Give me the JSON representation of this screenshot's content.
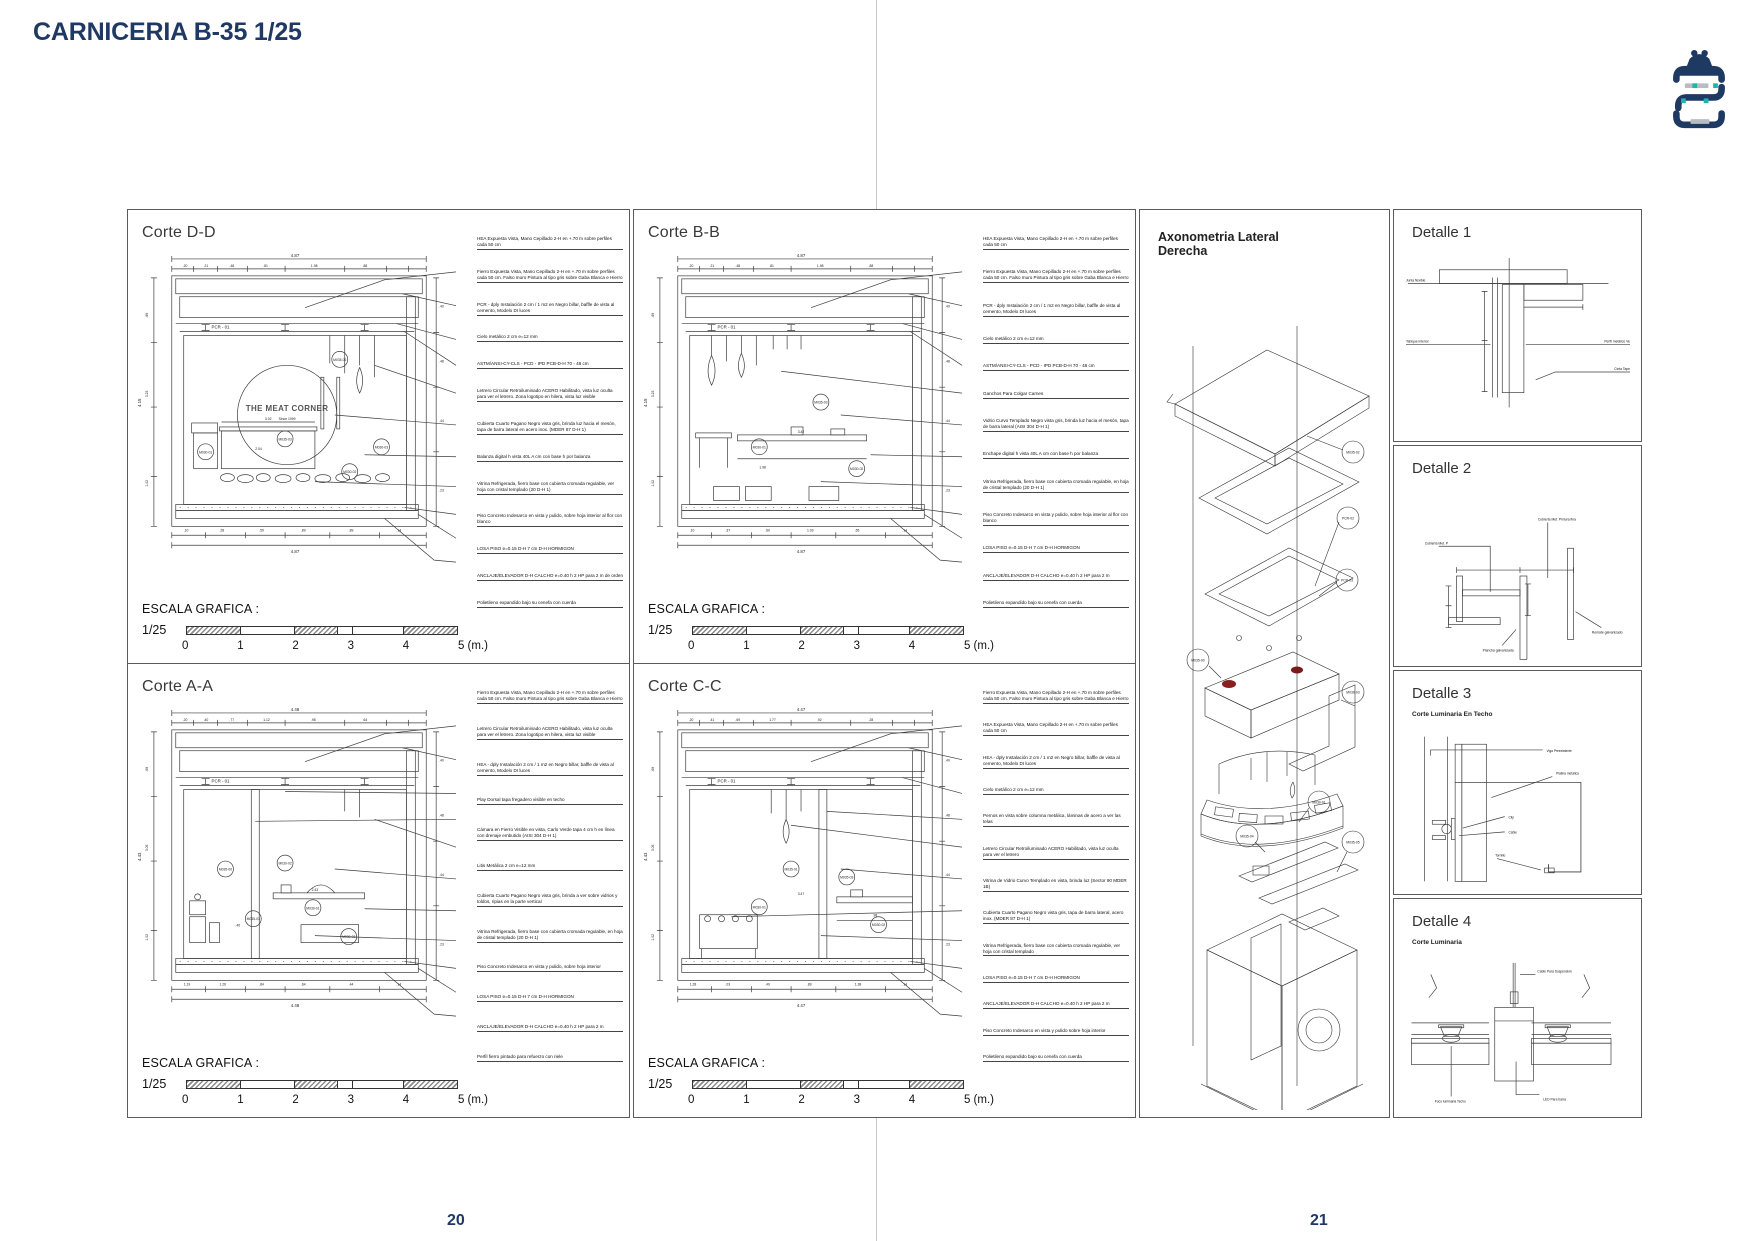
{
  "page": {
    "title": "CARNICERIA B-35 1/25",
    "page_number_left": "20",
    "page_number_right": "21",
    "accent_color": "#203864"
  },
  "scale": {
    "label": "ESCALA GRAFICA :",
    "ratio": "1/25",
    "ticks": [
      "0",
      "1",
      "2",
      "3",
      "4"
    ],
    "end_label": "5 (m.)"
  },
  "cortes": [
    {
      "title": "Corte D-D",
      "beam_label": "PCR - 01",
      "logo_text": "THE MEAT CORNER",
      "logo_sub": "Since 1999",
      "dims": {
        "top_total": "4.87",
        "bottom_total": "4.87",
        "height_total": "4.15",
        "top_segs": [
          ".20",
          ".21",
          ".48",
          ".81",
          "1.98",
          ".88"
        ],
        "bottom_segs": [
          ".10",
          ".28",
          ".59",
          ".89",
          ".89",
          ".14"
        ],
        "left_segs": [
          ".69",
          "3.23",
          "1.02"
        ],
        "right_segs": [
          ".40",
          ".48",
          ".44",
          ".23"
        ],
        "inner": [
          "3.02",
          "2.04"
        ]
      },
      "bubbles": [
        "M035-02",
        "M035-03",
        "M030-01",
        "M030-02",
        "M030-03"
      ],
      "annotations": [
        "HEA Expuesta Vista, Mano Cepillado 2-H en +.70 m sobre perfiles cada 50 cm",
        "Fierro Expuesta Vista, Mano Cepillado 2-H en +.70 m sobre perfiles cada 50 cm. Falso muro Pintura al tipo gris sobre Gaba Blanca e Hierro",
        "PCR - dply Instalación 2 cm / 1 m2 en Negro billar, baffle de vista al cemento, Modelo DI luces",
        "Cielo metálico 2 cm e=12 mm",
        "ASTM/ANSI-CY-CLS - PCD - IPD PCB-D-H 70 - 48 cm",
        "Letrero Circular Retroiluminado ACERO Habilitado, vista luz oculta para ver el letrero. Zona logotipo en hilera, vista luz visible",
        "Cubierta Cuarto Pagano Negro vista gris, brinda luz hacia el mesón, tapa de barra lateral en acero inox. (MDER 87 D-H 1)",
        "Balanza digital h vista 40L A cm con base h por balanza",
        "Vitrina Refrigerada, fierro base con cubierta cromada regulable, ver hoja con cristal templado (20 D-H 1)",
        "Piso Concreto Indesarco en vista y pulido, sobre hoja interior al flor con blanco",
        "LOSA PISO e=0.15 D-H 7 cm D-H HORMIGON",
        "ANCLAJE/ELEVADOR D-H CALCHO e=0.40 h 2 HP para 2 m de orden",
        "Polietileno expandido bajo su cenefa con cuerda"
      ]
    },
    {
      "title": "Corte B-B",
      "beam_label": "PCR - 01",
      "dims": {
        "top_total": "4.87",
        "bottom_total": "4.87",
        "height_total": "4.15",
        "top_segs": [
          ".20",
          ".21",
          ".48",
          ".81",
          "1.98",
          ".88"
        ],
        "bottom_segs": [
          ".10",
          ".37",
          ".60",
          "1.03",
          ".65",
          ".14"
        ],
        "left_segs": [
          ".69",
          "3.23",
          "1.02"
        ],
        "right_segs": [
          ".40",
          ".48",
          ".44",
          ".23"
        ],
        "inner": [
          "3.42",
          "1.98"
        ]
      },
      "bubbles": [
        "M035-03",
        "M030-01",
        "M030-02"
      ],
      "annotations": [
        "HEA Expuesta Vista, Mano Cepillado 2-H en +.70 m sobre perfiles cada 50 cm",
        "Fierro Expuesta Vista, Mano Cepillado 2-H en +.70 m sobre perfiles cada 50 cm. Falso muro Pintura al tipo gris sobre Gaba Blanca e Hierro",
        "PCR - dply Instalación 2 cm / 1 m2 en Negro billar, baffle de vista al cemento, Modelo DI luces",
        "Cielo metálico 2 cm e=12 mm",
        "ASTM/ANSI-CY-CLS - PCD - IPD PCB-D-H 70 - 48 cm",
        "Ganchos Para Colgar Carnes",
        "Vidrio Curvo Templado Negro vista gris, brinda luz hacia el mesón, tapa de barra lateral (AISI 304 D-H 1)",
        "Enchape digital h vista 40L A cm con base h por balanza",
        "Vitrina Refrigerada, fierro base con cubierta cromada regulable, en hoja de cristal templado (20 D-H 1)",
        "Piso Concreto Indesarco en vista y pulido, sobre hoja interior al flor con blanco",
        "LOSA PISO e=0.15 D-H 7 cm D-H HORMIGON",
        "ANCLAJE/ELEVADOR D-H CALCHO e=0.40 h 2 HP para 2 m",
        "Polietileno expandido bajo su cenefa con cuerda"
      ]
    },
    {
      "title": "Corte A-A",
      "beam_label": "PCR - 01",
      "dims": {
        "top_total": "4.48",
        "bottom_total": "4.48",
        "height_total": "4.43",
        "top_segs": [
          ".20",
          ".40",
          ".77",
          "1.12",
          ".98",
          ".64"
        ],
        "bottom_segs": [
          "1.19",
          "1.26",
          ".84",
          ".64",
          ".44",
          ".14"
        ],
        "left_segs": [
          ".69",
          "3.05",
          "1.02"
        ],
        "right_segs": [
          ".40",
          ".48",
          ".44",
          ".23"
        ],
        "inner": [
          "2.43",
          ".40"
        ]
      },
      "bubbles": [
        "M035-00",
        "M030-02",
        "M030-01",
        "M035-03",
        "M030-03"
      ],
      "annotations": [
        "Fierro Expuesta Vista, Mano Cepillado 2-H en +.70 m sobre perfiles cada 50 cm. Falso muro Pintura al tipo gris sobre Gaba Blanca e Hierro",
        "Letrero Circular Retroiluminado ACERO Habilitado, vista luz oculta para ver el letrero. Zona logotipo en hilera, vista luz visible",
        "HEA - dply Instalación 2 cm / 1 m2 en Negro billar, baffle de vista al cemento, Modelo DI luces",
        "Play Dorsal tapa fregadero visible en techo",
        "Cámara en Fierro Visible en vista, Carlo Verde tapa 4 cm h en línea con drenaje embutido (AISI 304 D-H 1)",
        "Litis Metálica 2 cm e=12 mm",
        "Cubierta Cuarto Pagano Negro vista gris, brinda a ver sobre vidrios y toldos, ripias en la parte vertical",
        "Vitrina Refrigerada, fierro base con cubierta cromada regulable, en hoja de cristal templado (20 D-H 1)",
        "Piso Concreto Indesarco en vista y pulido, sobre hoja interior",
        "LOSA PISO e=0.15 D-H 7 cm D-H HORMIGON",
        "ANCLAJE/ELEVADOR D-H CALCHO e=0.40 h 2 HP para 2 m",
        "Perfil fierro pintado para refuerzo con riele"
      ]
    },
    {
      "title": "Corte C-C",
      "beam_label": "PCR - 01",
      "dims": {
        "top_total": "4.47",
        "bottom_total": "4.47",
        "height_total": "4.43",
        "top_segs": [
          ".20",
          ".41",
          ".69",
          "1.77",
          ".92",
          ".28"
        ],
        "bottom_segs": [
          "1.28",
          ".03",
          ".49",
          ".89",
          "1.38",
          ".14"
        ],
        "left_segs": [
          ".69",
          "3.05",
          "1.02"
        ],
        "right_segs": [
          ".40",
          ".48",
          ".44",
          ".23"
        ],
        "inner": [
          "3.47",
          ".98"
        ]
      },
      "bubbles": [
        "M035-01",
        "M030-01",
        "M035-03",
        "M030-02"
      ],
      "annotations": [
        "Fierro Expuesta Vista, Mano Cepillado 2-H en +.70 m sobre perfiles cada 50 cm. Falso muro Pintura al tipo gris sobre Gaba Blanca e Hierro",
        "HEA Expuesta Vista, Mano Cepillado 2-H en +.70 m sobre perfiles cada 50 cm",
        "HEA - dply Instalación 2 cm / 1 m2 en Negro billar, baffle de vista al cemento, Modelo DI luces",
        "Cielo metálico 2 cm e=12 mm",
        "Pernos en vista sobre columna metálica, láminas de acero a ver las telas",
        "Letrero Circular Retroiluminado ACERO Habilitado, vista luz oculta para ver el letrero",
        "Vitrina de Vidrio Curvo Templado en vista, brinda luz (Sector 90 MDER 1B)",
        "Cubierta Cuarto Pagano Negro vista gris, tapa de barra lateral, acero inox. (MDER 87 D-H 1)",
        "Vitrina Refrigerada, fierro base con cubierta cromada regulable, ver hoja con cristal templado",
        "LOSA PISO e=0.15 D-H 7 cm D-H HORMIGON",
        "ANCLAJE/ELEVADOR D-H CALCHO e=0.40 h 2 HP para 2 m",
        "Piso Concreto Indesarco en vista y pulido sobre hoja interior",
        "Polietileno expandido bajo su cenefa con cuerda"
      ]
    }
  ],
  "axonometria": {
    "title_line1": "Axonometria Lateral",
    "title_line2": "Derecha",
    "callouts": [
      "M035-02",
      "PCR-02",
      "PCR-03",
      "M035-00",
      "M030-03",
      "M030-01",
      "M035-04",
      "M035-05"
    ]
  },
  "detalles": [
    {
      "title": "Detalle 1",
      "subtitle": "",
      "labels": [
        "Junta flexible",
        "Tabique interior",
        "Perfil metálico Ve",
        "Cinta Tape"
      ]
    },
    {
      "title": "Detalle 2",
      "subtitle": "",
      "labels": [
        "Cubierta Met. P",
        "Cubierta Met. Pintura fina",
        "Plancha galvanizada",
        "Remate galvanizado"
      ]
    },
    {
      "title": "Detalle 3",
      "subtitle": "Corte Luminaria En Techo",
      "labels": [
        "Viga Preexistente",
        "Platina metálica",
        "Clip",
        "Cable",
        "Tornillo"
      ]
    },
    {
      "title": "Detalle 4",
      "subtitle": "Corte Luminaria",
      "labels": [
        "Cable Para Suspensión",
        "Foco luminaria Techo",
        "LED Para barra"
      ]
    }
  ],
  "logo": {
    "navy": "#1e3a63",
    "teal": "#1ab5b0",
    "gray": "#b9bcc2"
  }
}
